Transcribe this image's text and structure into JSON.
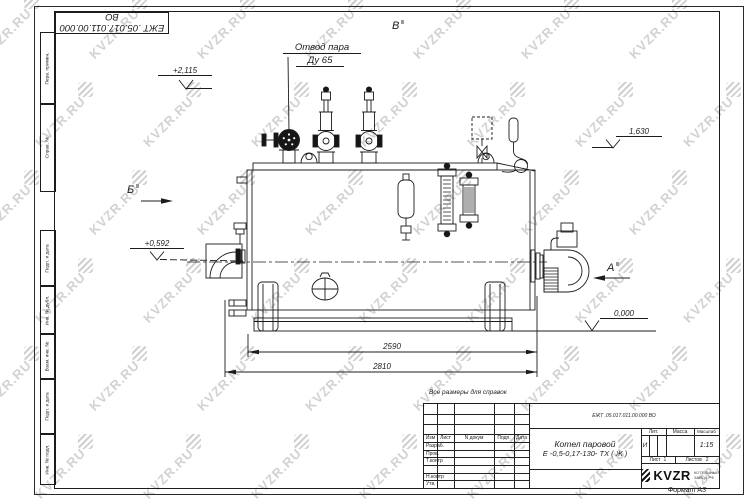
{
  "watermark": {
    "text": "KVZR.RU"
  },
  "labels": {
    "steam1": "Отвод пара",
    "steam2": "Ду 65",
    "note": "Все размеры для справок"
  },
  "elev": {
    "top": "+2,115",
    "right": "1,630",
    "mid": "+0,592",
    "zero": "0,000"
  },
  "dims": {
    "len1": "2590",
    "len2": "2810"
  },
  "views": {
    "a": "А",
    "b": "Б",
    "v": "В"
  },
  "margin": [
    "Перв. примен.",
    "Справ. №",
    "Подп. и дата",
    "Инв. № дубл.",
    "Взам. инв. №",
    "Подп. и дата",
    "Инв. № подл."
  ],
  "tb": {
    "doc_number": "ЕЖТ .05.017.011.00.000  ВО",
    "hdr": [
      "Изм",
      "Лист",
      "N докум",
      "Подп.",
      "Дата"
    ],
    "rows": [
      "Разраб.",
      "Пров.",
      "Т.контр",
      "Н.контр",
      "Утв."
    ],
    "name1": "Котел паровой",
    "name2": "Е -0,5-0,17-130- ТХ ( Ж )",
    "lit_h": "Лит.",
    "mass_h": "Масса",
    "scale_h": "Масштаб",
    "lit": "И",
    "scale": "1:15",
    "sheet_h": "Лист",
    "sheet": "1",
    "sheets_h": "Листов",
    "sheets": "2",
    "logo": "KVZR",
    "logo_sub1": "КОТЕЛЬНЫЙ",
    "logo_sub2": "ЗАВОД.РФ",
    "format": "Формат А3"
  }
}
